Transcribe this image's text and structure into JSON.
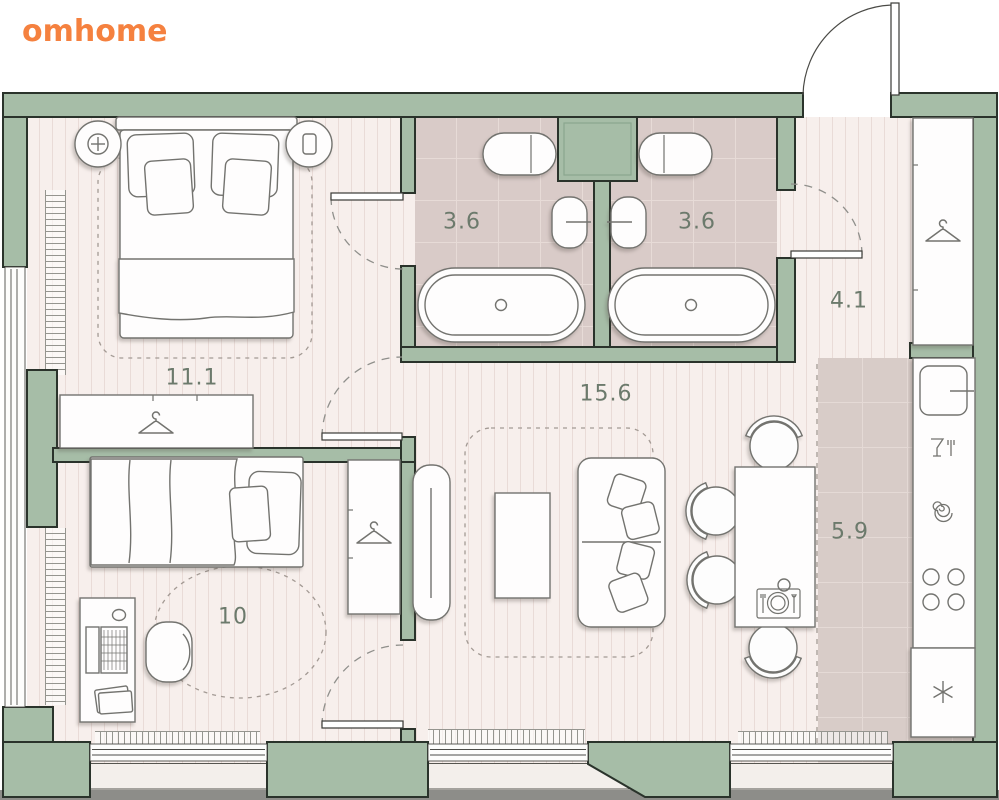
{
  "brand": {
    "logo_text": "omhome",
    "logo_color": "#f5813f"
  },
  "plan": {
    "rooms": [
      {
        "name": "bedroom",
        "area": "11.1"
      },
      {
        "name": "bathroom-1",
        "area": "3.6"
      },
      {
        "name": "bathroom-2",
        "area": "3.6"
      },
      {
        "name": "hallway",
        "area": "4.1"
      },
      {
        "name": "living-room",
        "area": "15.6"
      },
      {
        "name": "kitchen",
        "area": "5.9"
      },
      {
        "name": "kids-room",
        "area": "10"
      }
    ],
    "colors": {
      "wall_fill": "#a6bda7",
      "wall_outline": "#2a332b",
      "wood_floor": "#f7efec",
      "wood_stripe": "#e9dbd7",
      "bath_tile": "#d9cbc8",
      "kitchen_tile": "#d8ccc8",
      "label_text": "#6c7a6c",
      "facade_strip": "#8d8d89"
    }
  }
}
